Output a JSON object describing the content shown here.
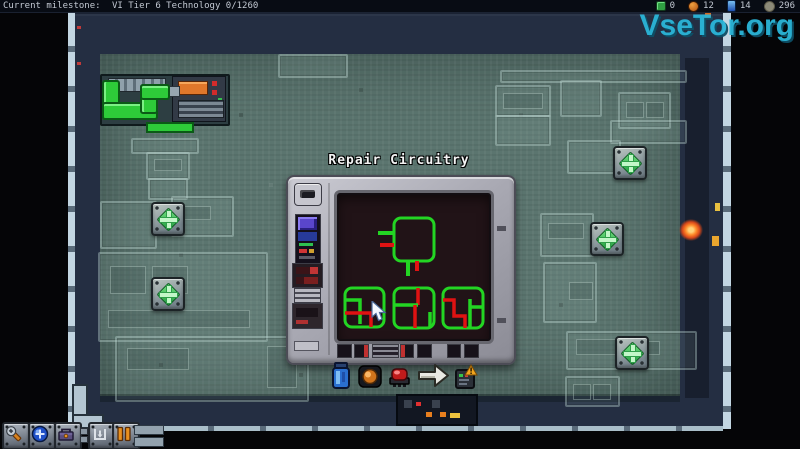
{
  "top_bar": {
    "milestone_label": "Current milestone:",
    "milestone_value": "VI Tier 6 Technology 0/1260",
    "counters": [
      {
        "icon": "milestone-check-icon",
        "value": "0"
      },
      {
        "icon": "mineral-orb-icon",
        "value": "12"
      },
      {
        "icon": "energy-cell-icon",
        "value": "14"
      },
      {
        "icon": "credits-coin-icon",
        "value": "296"
      }
    ]
  },
  "watermark": {
    "text": "VseTor.org",
    "color": "#2bb6d9"
  },
  "repair_dialog": {
    "title": "Repair Circuitry",
    "items": [
      {
        "icon": "blue-canister-icon"
      },
      {
        "icon": "orange-orb-icon"
      },
      {
        "icon": "red-chip-icon"
      },
      {
        "icon": "proceed-arrow-icon"
      },
      {
        "icon": "device-warning-icon"
      }
    ]
  },
  "toolbar": {
    "buttons": [
      {
        "icon": "repair-tool-icon"
      },
      {
        "icon": "scanner-orb-icon"
      },
      {
        "icon": "toolbox-icon"
      },
      {
        "icon": "place-structure-icon"
      },
      {
        "icon": "pause-doors-icon"
      }
    ]
  },
  "colors": {
    "circuit_green": "#23d523",
    "circuit_red": "#e01212",
    "plus_green": "#3fd05a",
    "accent_cyan": "#2bb6d9",
    "floor": "#5b756f",
    "hull": "#242e42"
  }
}
